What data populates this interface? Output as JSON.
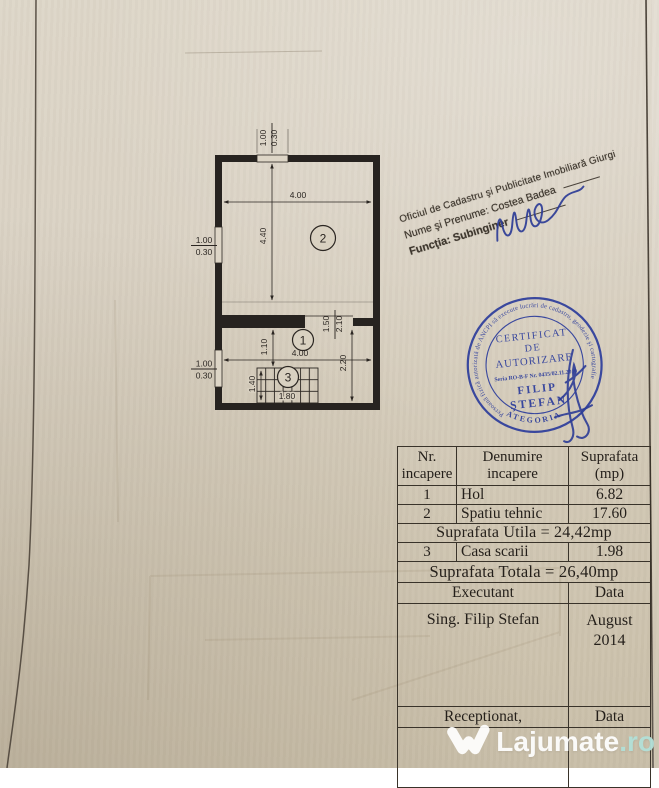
{
  "floor_plan": {
    "rooms": [
      {
        "number": "1"
      },
      {
        "number": "2"
      },
      {
        "number": "3"
      }
    ],
    "dims": {
      "room2_width": "4.00",
      "room2_depth": "4.40",
      "hall_width": "4.00",
      "hall_depth": "1.10",
      "right_depth": "2.20",
      "opening_width": "1.50",
      "opening_height": "2.10",
      "stairs_width": "1.80",
      "stairs_depth": "1.40",
      "window_top": {
        "w": "1.00",
        "d": "0.30"
      },
      "window_left_upper": {
        "w": "1.00",
        "d": "0.30"
      },
      "window_left_lower": {
        "w": "1.00",
        "d": "0.30"
      }
    }
  },
  "office_stamp": {
    "line1": "Oficiul de Cadastru şi Publicitate Imobiliară Giurgi",
    "line2": "Nume şi Prenume: Costea Badea",
    "line3": "Funcţia: Subinginer",
    "ink_color": "#3f382f"
  },
  "round_stamp": {
    "ring_text": "Persoană fizică autorizată de ANCPI să execute lucrări de cadastru, geodezie şi cartografie",
    "bottom_arc": "CATEGORIA A",
    "line1": "CERTIFICAT",
    "line2": "DE",
    "line3": "AUTORIZARE",
    "serial": "Seria RO-B-F Nr. 0435/02.11.2010",
    "name_line1": "FILIP",
    "name_line2": "ŞTEFAN",
    "ink_color": "#2e3e9c"
  },
  "table": {
    "headers": {
      "col1_line1": "Nr.",
      "col1_line2": "incapere",
      "col2_line1": "Denumire",
      "col2_line2": "incapere",
      "col3_line1": "Suprafata",
      "col3_line2": "(mp)"
    },
    "rows": [
      {
        "nr": "1",
        "name": "Hol",
        "area": "6.82"
      },
      {
        "nr": "2",
        "name": "Spatiu tehnic",
        "area": "17.60"
      },
      {
        "nr": "3",
        "name": "Casa scarii",
        "area": "1.98"
      }
    ],
    "suprafata_utila": "Suprafata Utila = 24,42mp",
    "suprafata_totala": "Suprafata Totala = 26,40mp",
    "executant_label": "Executant",
    "executant_data_label": "Data",
    "executant_name": "Sing. Filip Stefan",
    "date_month": "August",
    "date_year": "2014",
    "receptionat_label": "Receptionat,",
    "receptionat_data_label": "Data"
  },
  "watermark": {
    "brand": "Lajumate",
    "suffix": ".ro",
    "brand_color": "#ffffff",
    "suffix_color": "#b2e0d8"
  }
}
